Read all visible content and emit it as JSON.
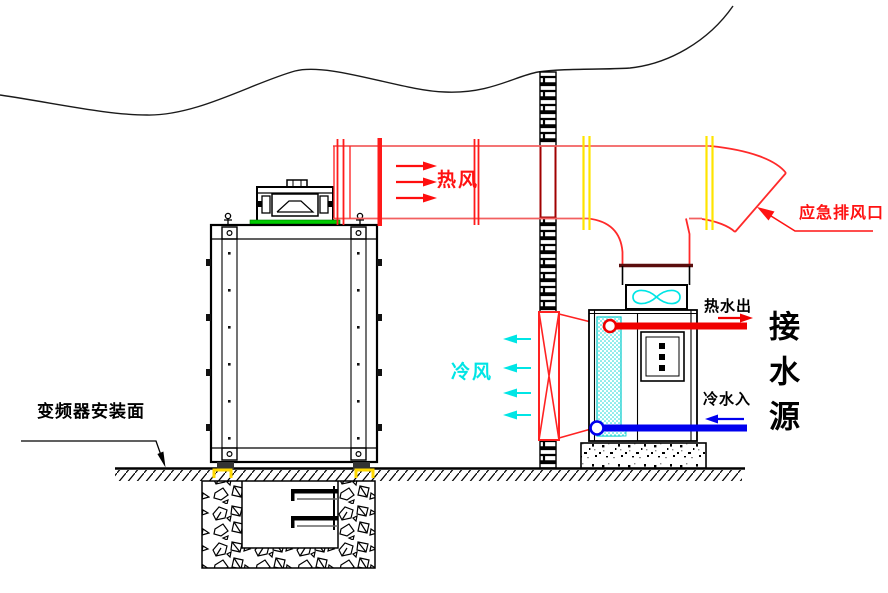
{
  "diagram": {
    "labels": {
      "hot_air": "热风",
      "cold_air": "冷风",
      "emergency_exhaust_outlet": "应急排风口",
      "hot_water_out": "热水出",
      "cold_water_in": "冷水入",
      "water_source": "接水源",
      "inverter_mounting_surface": "变频器安装面"
    },
    "colors": {
      "duct_red": "#f26060",
      "accent_red": "#ff1212",
      "cold_cyan": "#00e5e5",
      "water_blue": "#0000ee",
      "gasket_green": "#00cc00",
      "flange_yellow": "#ffe400",
      "wall_dark_red": "#a00000",
      "line_black": "#000000"
    },
    "components": [
      "terrain-break-line",
      "brick-wall-column",
      "air-handling-unit",
      "hot-air-supply-duct",
      "emergency-exhaust-elbow",
      "flex-connector-x-brace",
      "heat-recovery-unit",
      "fan-section",
      "coil-section",
      "control-panel",
      "hot-water-pipe",
      "cold-water-pipe",
      "concrete-pad",
      "foundation-pit",
      "anchor-bolts",
      "ground-line"
    ]
  }
}
